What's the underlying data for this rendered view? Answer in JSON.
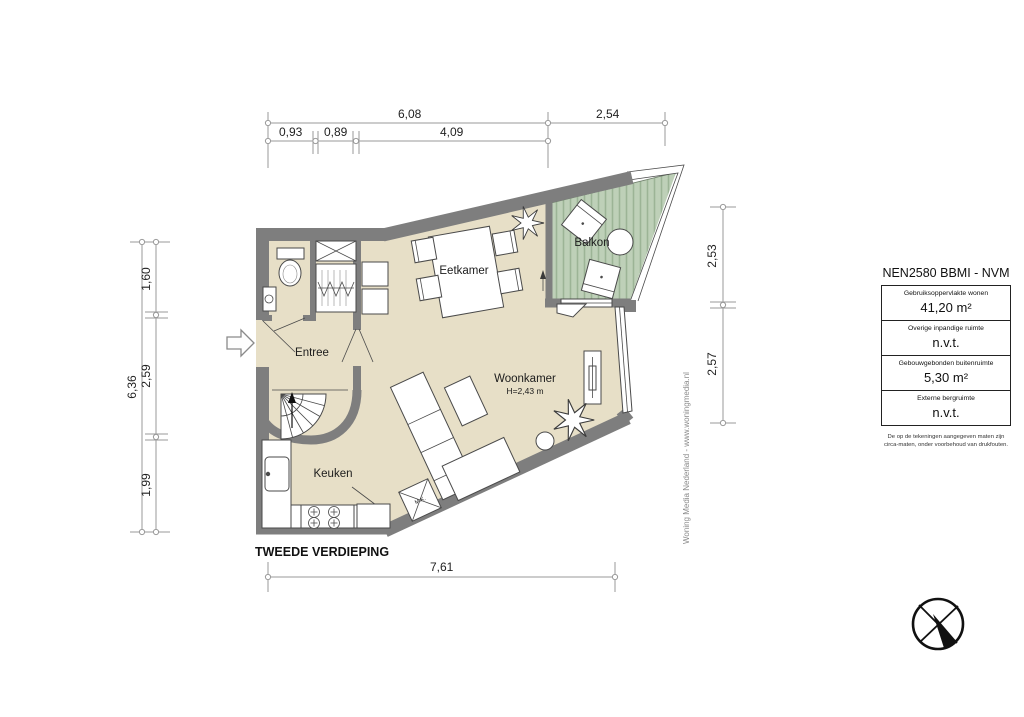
{
  "plan": {
    "floor_label": "TWEEDE VERDIEPING",
    "rooms": {
      "eetkamer": "Eetkamer",
      "balkon": "Balkon",
      "entree": "Entree",
      "woonkamer": "Woonkamer",
      "woonkamer_height": "H=2,43 m",
      "keuken": "Keuken"
    },
    "annotations": {
      "mk": "M.K."
    },
    "dimensions": {
      "top_total_left": "6,08",
      "top_total_right": "2,54",
      "top_sub": [
        "0,93",
        "0,89",
        "4,09"
      ],
      "left_total": "6,36",
      "left_sub": [
        "1,60",
        "2,59",
        "1,99"
      ],
      "right_sub": [
        "2,53",
        "2,57"
      ],
      "bottom_total": "7,61"
    },
    "watermark": "Woning Media Nederland - www.woningmedia.nl",
    "colors": {
      "floor": "#e7dfc7",
      "balcony": "#bed0b8",
      "balcony_stripe": "#9cb496",
      "wall": "#7e7e7e"
    }
  },
  "panel": {
    "title": "NEN2580 BBMI - NVM",
    "rows": [
      {
        "label": "Gebruiksoppervlakte wonen",
        "value": "41,20 m²"
      },
      {
        "label": "Overige inpandige ruimte",
        "value": "n.v.t."
      },
      {
        "label": "Gebouwgebonden buitenruimte",
        "value": "5,30 m²"
      },
      {
        "label": "Externe bergruimte",
        "value": "n.v.t."
      }
    ],
    "disclaimer": "De op de tekeningen aangegeven maten zijn circa-maten, onder voorbehoud van drukfouten."
  }
}
